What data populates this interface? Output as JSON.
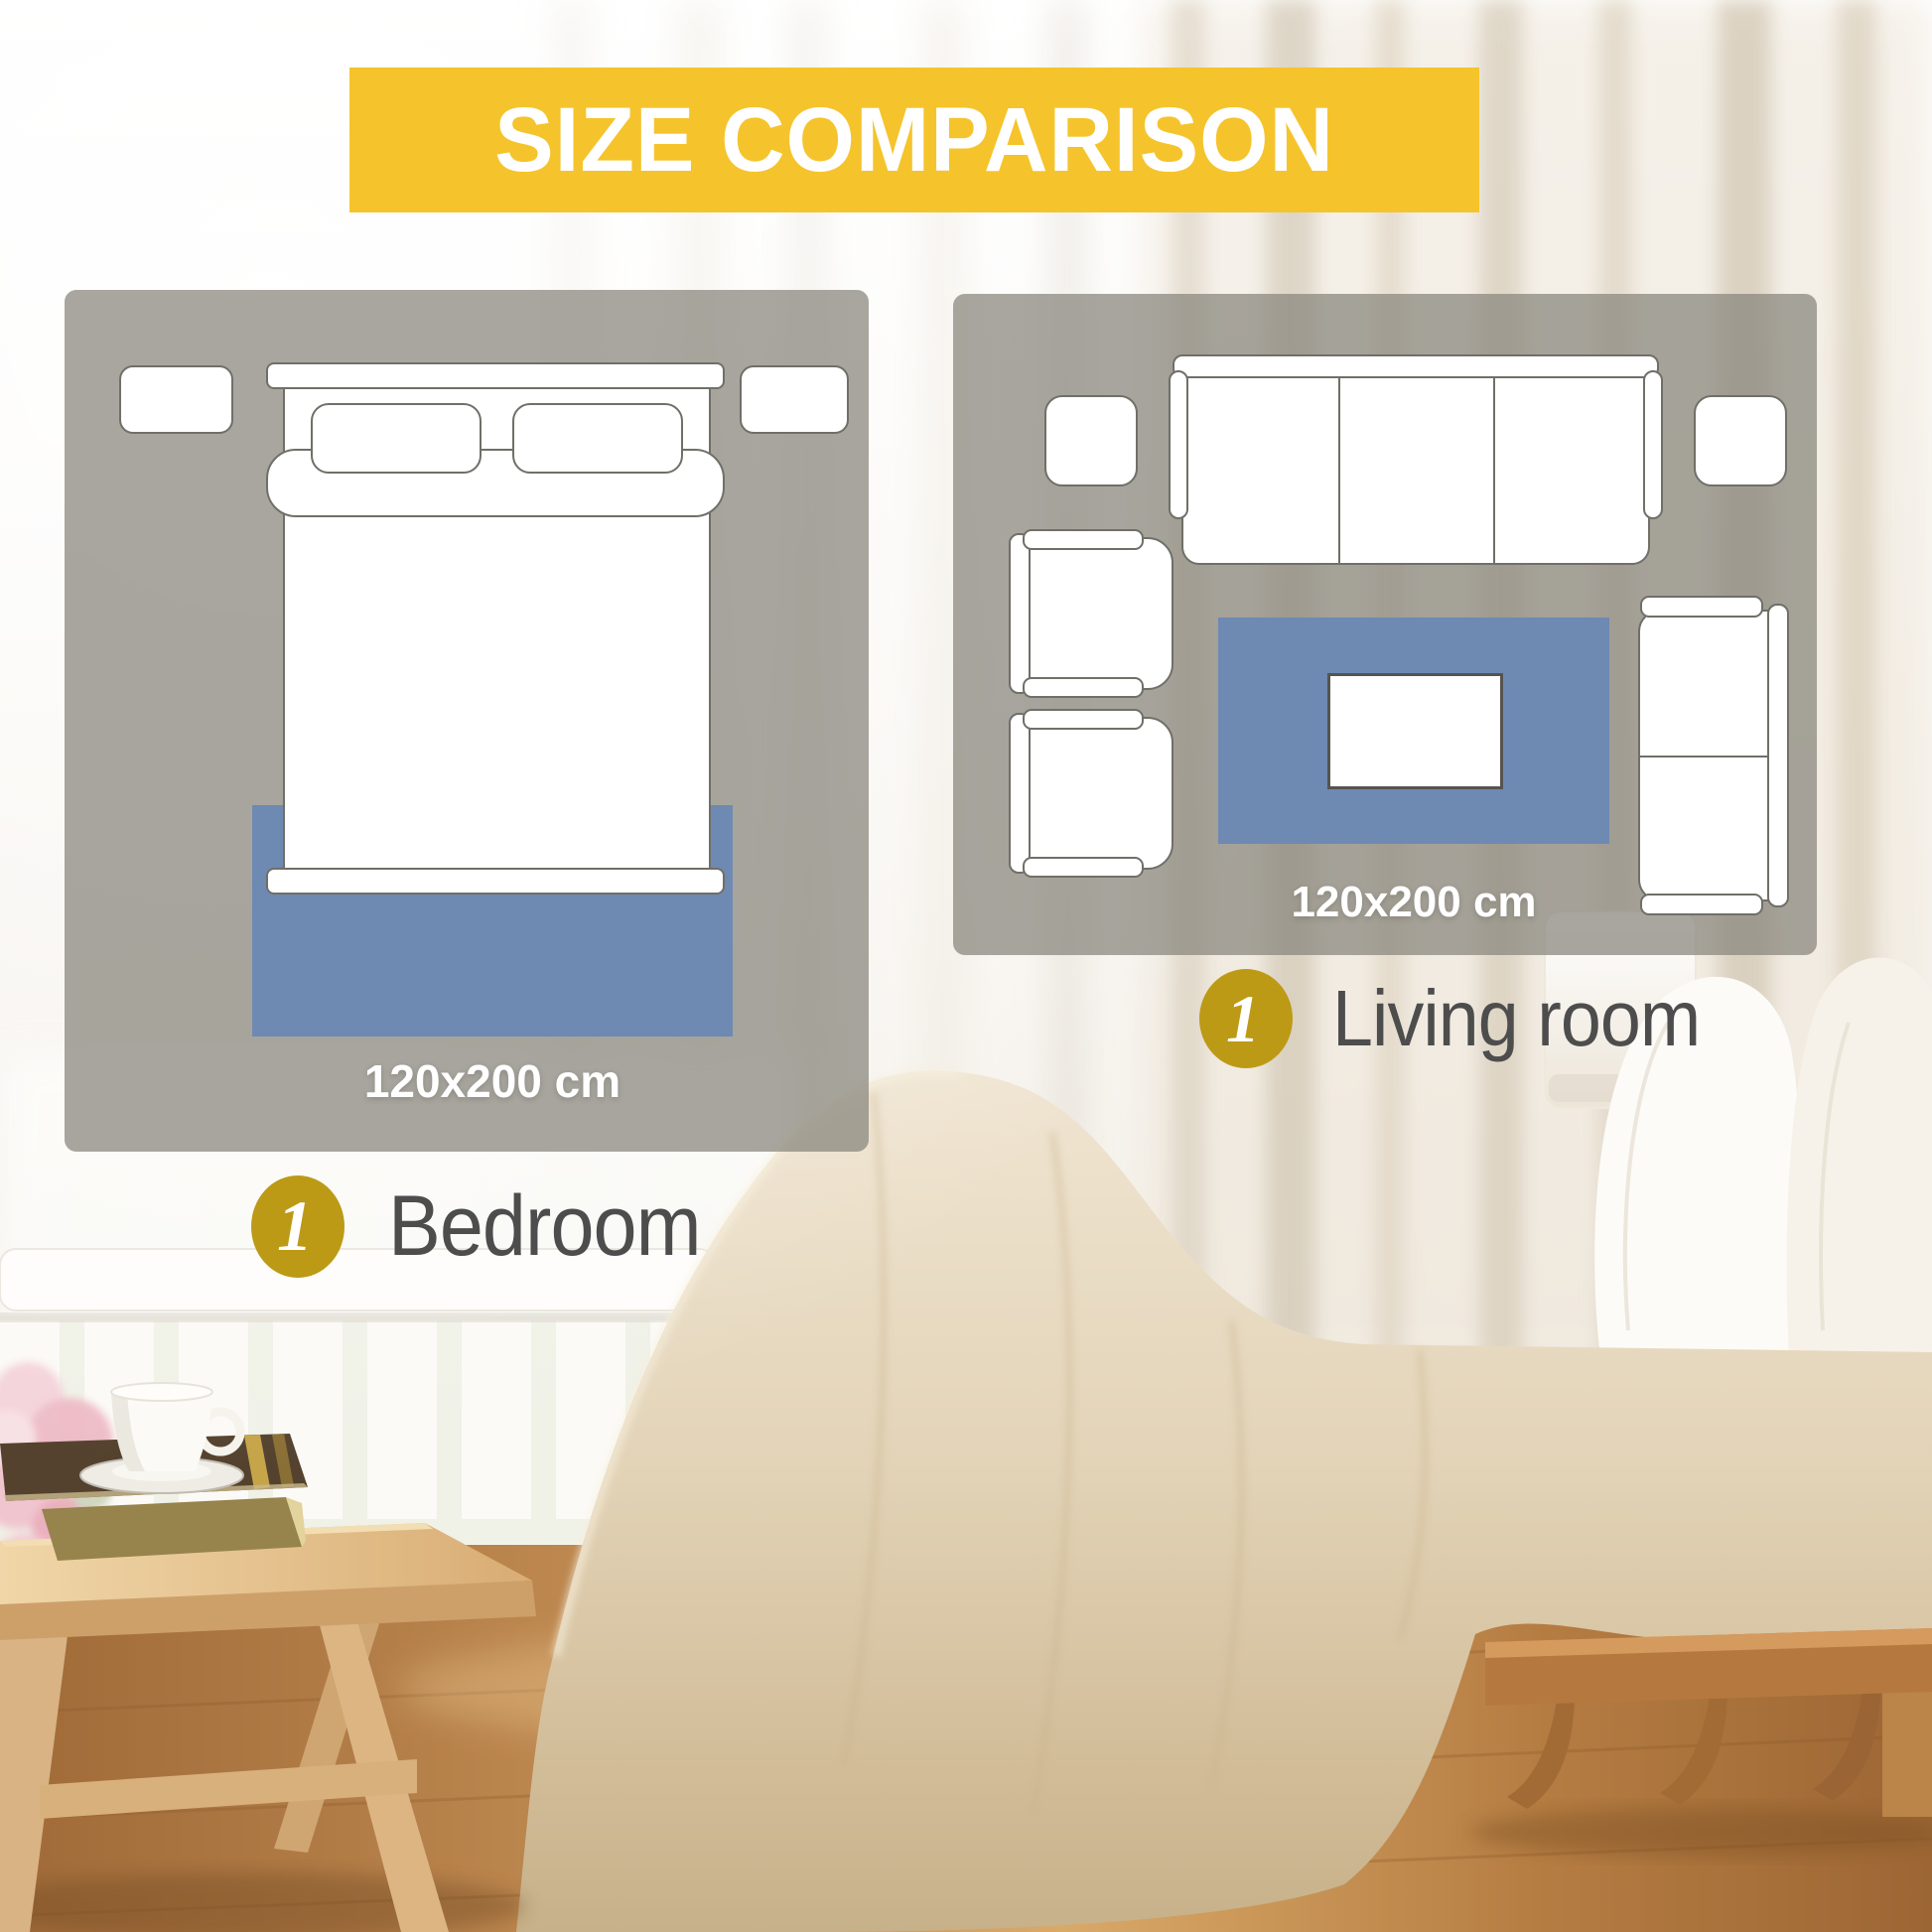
{
  "header": {
    "title": "SIZE COMPARISON"
  },
  "bedroom_panel": {
    "rug_size": "120x200 cm",
    "badge_number": "1",
    "room_label": "Bedroom"
  },
  "living_room_panel": {
    "rug_size": "120x200 cm",
    "badge_number": "1",
    "room_label": "Living room"
  },
  "colors": {
    "banner": "#F5C42C",
    "badge": "#BC9A16",
    "rug": "#6E89B2",
    "outline": "#706F68",
    "label_text": "#4D4D4D",
    "panel_overlay": "#A8A59D"
  }
}
